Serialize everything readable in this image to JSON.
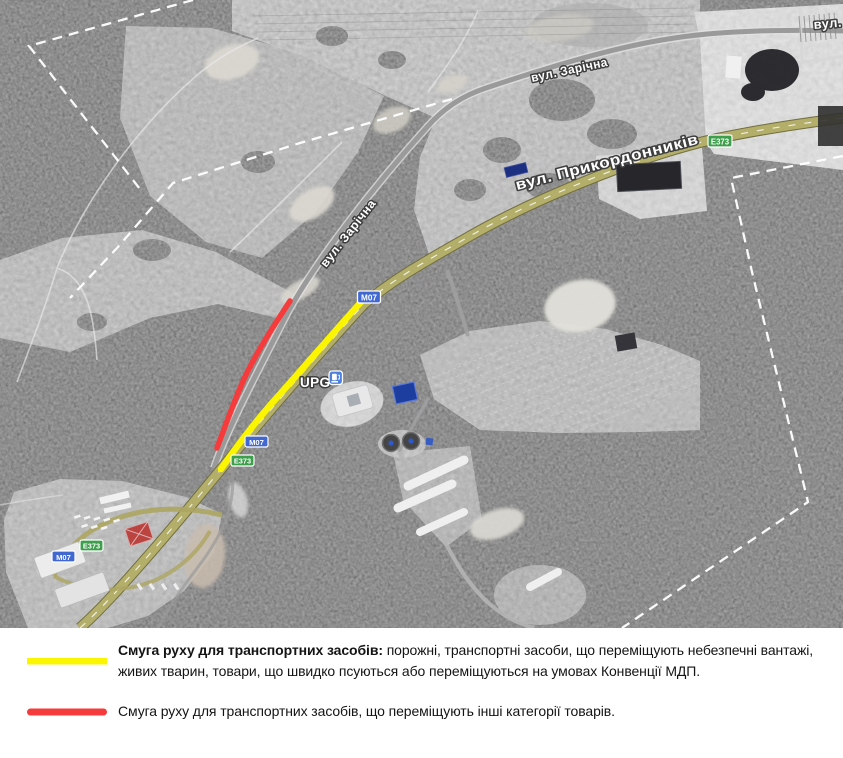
{
  "map": {
    "street_labels": {
      "zarichna": "вул. Зарічна",
      "prykordonnykiv": "вул. Прикордонників",
      "vul_cutoff": "вул.",
      "upg_station": "UPG"
    },
    "road_shields": {
      "m07": "M07",
      "e373": "E373"
    },
    "shield_colors": {
      "m07_blue": "#4068d0",
      "e373_green": "#3d9e4b"
    },
    "annotation_colors": {
      "yellow_route": "#fbf600",
      "red_route": "#f53b3b",
      "boundary_dash": "#ffffff"
    }
  },
  "legend": {
    "items": [
      {
        "line_color": "#fbf600",
        "label_bold": "Смуга руху для транспортних засобів:",
        "label_rest": "порожні, транспортні засоби, що переміщують небезпечні вантажі, живих тварин, товари, що швидко псуються або переміщуються на умовах Конвенції МДП."
      },
      {
        "line_color": "#f53b3b",
        "label": "Смуга руху для транспортних засобів, що переміщують інші категорії товарів."
      }
    ]
  }
}
